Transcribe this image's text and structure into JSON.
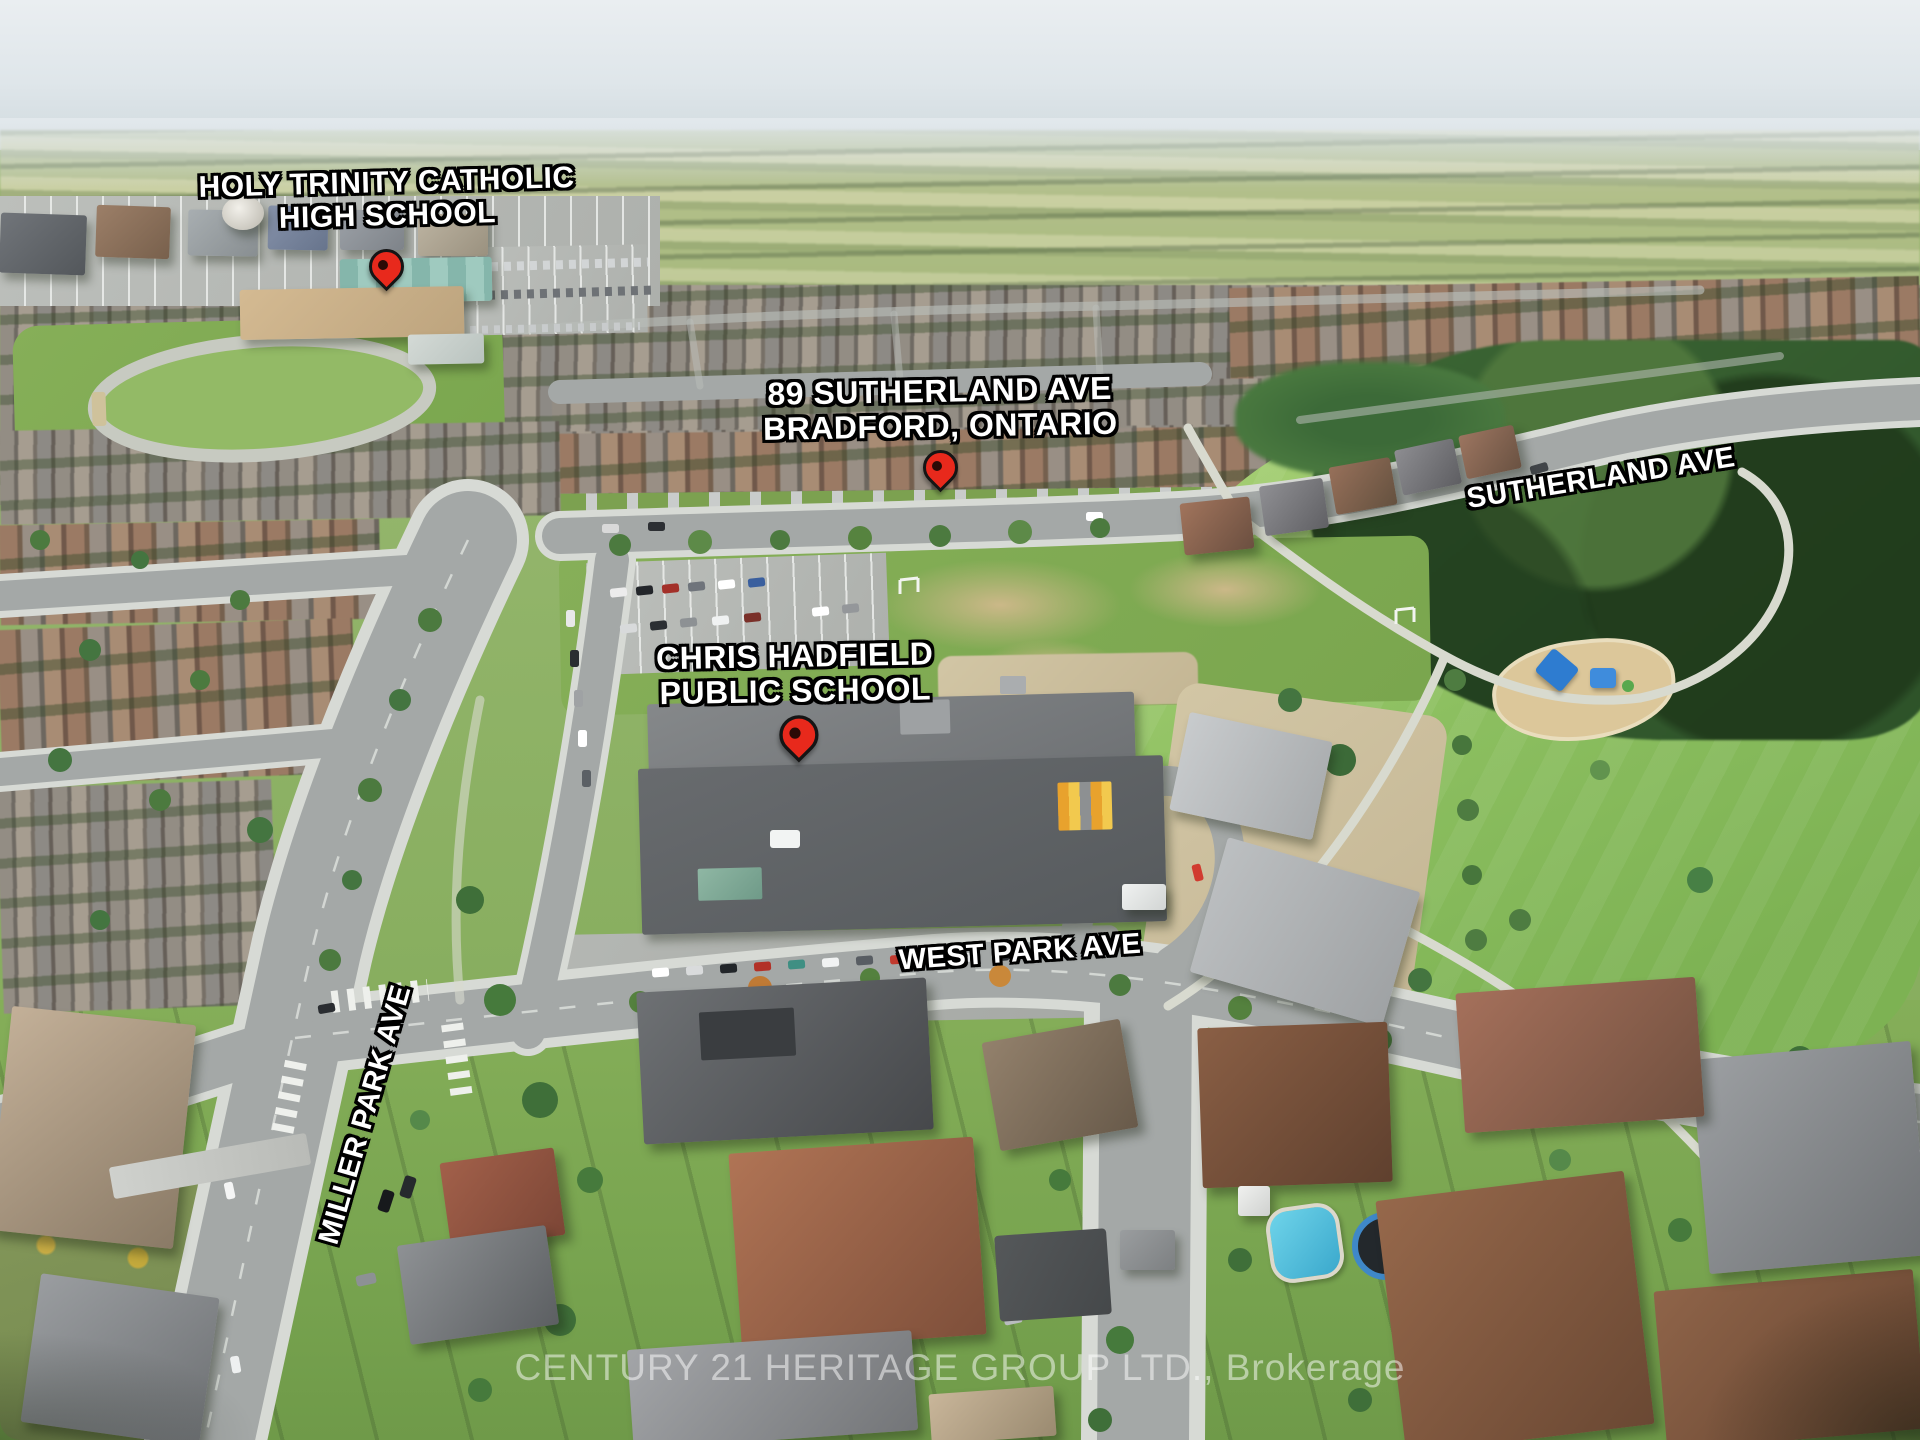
{
  "annotations": {
    "schools": [
      {
        "id": "holy-trinity",
        "line1": "HOLY TRINITY CATHOLIC",
        "line2": "HIGH SCHOOL"
      },
      {
        "id": "chris-hadfield",
        "line1": "CHRIS HADFIELD",
        "line2": "PUBLIC SCHOOL"
      }
    ],
    "subject_property": {
      "line1": "89 SUTHERLAND AVE",
      "line2": "BRADFORD, ONTARIO"
    },
    "street_labels": {
      "sutherland_ave": "SUTHERLAND AVE",
      "west_park_ave": "WEST PARK AVE",
      "miller_park_ave": "MILLER PARK AVE"
    },
    "pins": [
      {
        "id": "pin-holy-trinity-high-school"
      },
      {
        "id": "pin-89-sutherland-ave"
      },
      {
        "id": "pin-chris-hadfield-public-school"
      }
    ]
  },
  "watermark": {
    "text": "CENTURY 21 HERITAGE GROUP LTD., Brokerage"
  },
  "colors": {
    "pin_red": "#e8291c",
    "pin_outline": "#151515",
    "pin_dot": "#2b0a06",
    "label_fill": "#ffffff",
    "label_outline": "#000000",
    "watermark_color": "rgba(255,255,255,0.5)"
  }
}
